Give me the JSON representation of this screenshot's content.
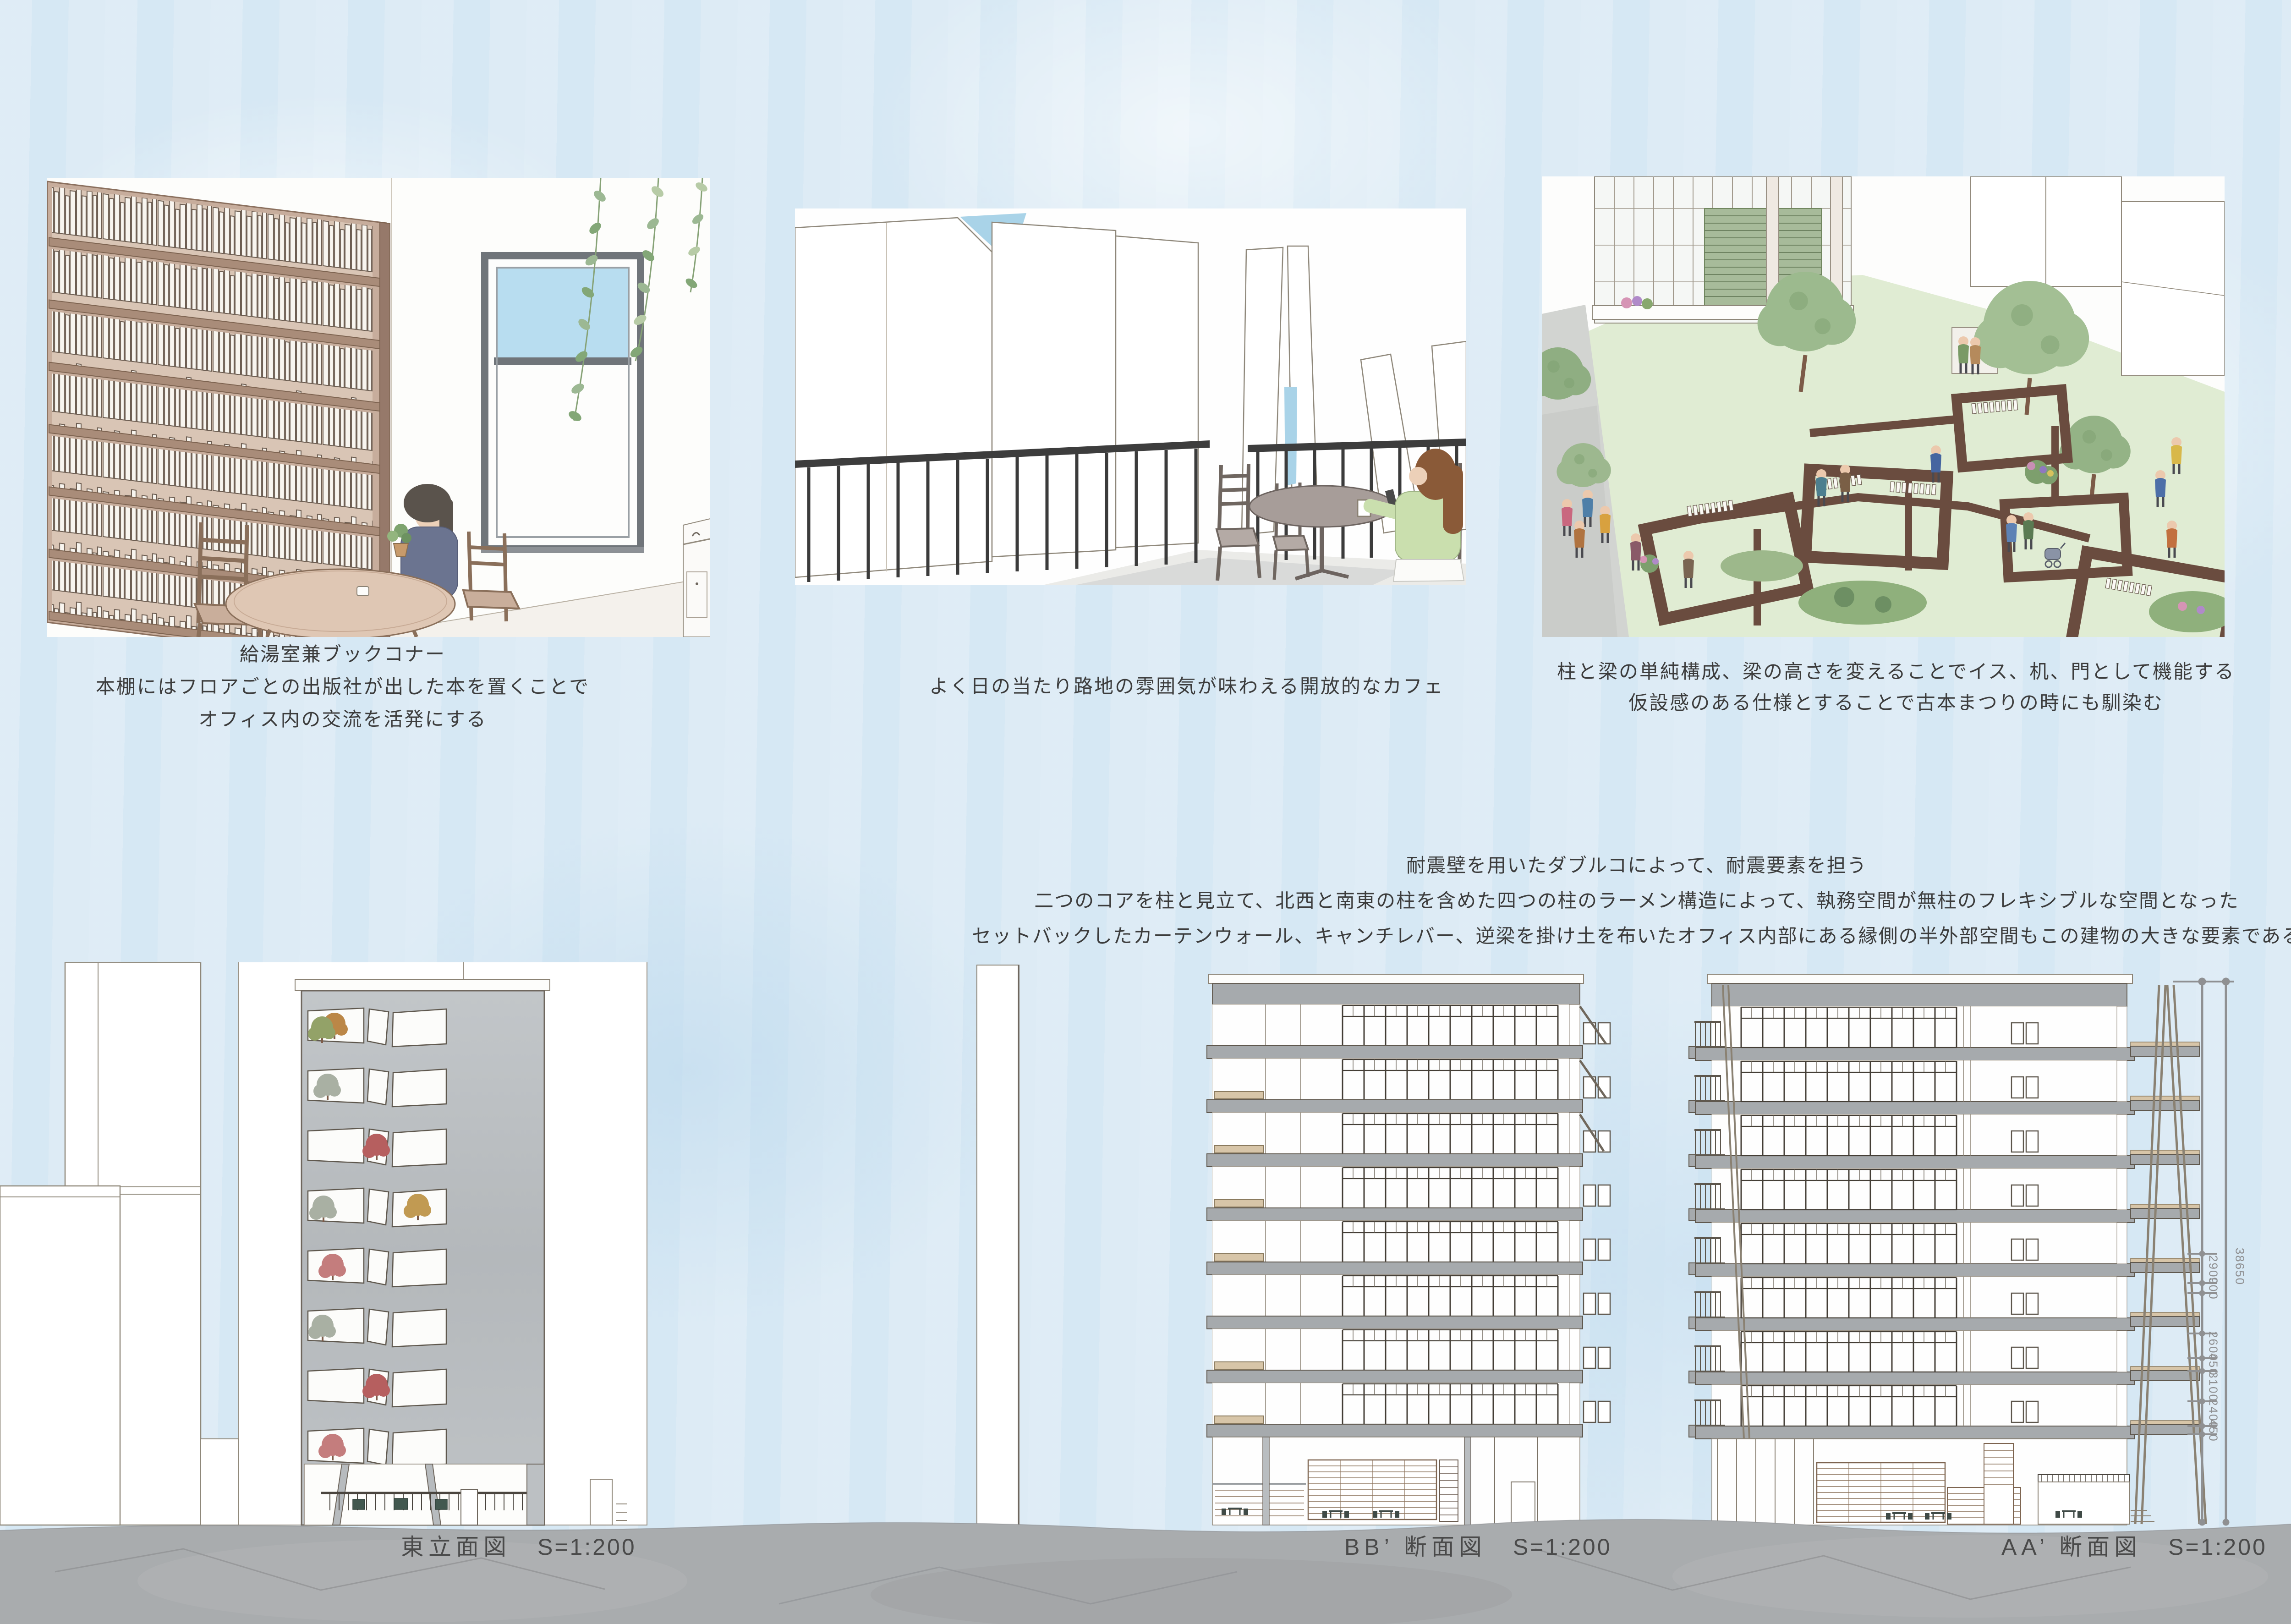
{
  "board": {
    "sky_color": "#d9e9f4",
    "ground_color": "#a9acae",
    "slab_gray": "#a6aaad",
    "timber_brown": "#6a4c3f",
    "bookshelf_wood": "#c7ad9c",
    "grass_green": "#e0ecd3",
    "sky_slit_blue": "#a9d3e8"
  },
  "renders": [
    {
      "name": "book-corner",
      "caption_lines": [
        "給湯室兼ブックコナー",
        "本棚にはフロアごとの出版社が出した本を置くことで",
        "オフィス内の交流を活発にする"
      ]
    },
    {
      "name": "alley-cafe",
      "caption_lines": [
        "よく日の当たり路地の雰囲気が味わえる開放的なカフェ"
      ]
    },
    {
      "name": "garden-frames",
      "caption_lines": [
        "柱と梁の単純構成、梁の高さを変えることでイス、机、門として機能する",
        "仮設感のある仕様とすることで古本まつりの時にも馴染む"
      ]
    }
  ],
  "structure_notes": {
    "lines": [
      "耐震壁を用いたダブルコによって、耐震要素を担う",
      "二つのコアを柱と見立て、北西と南東の柱を含めた四つの柱のラーメン構造によって、執務空間が無柱のフレキシブルな空間となった",
      "セットバックしたカーテンウォール、キャンチレバー、逆梁を掛け土を布いたオフィス内部にある縁側の半外部空間もこの建物の大きな要素である"
    ]
  },
  "drawings": [
    {
      "title": "東立面図",
      "scale": "S=1:200"
    },
    {
      "title": "BB’ 断面図",
      "scale": "S=1:200"
    },
    {
      "title": "AA’ 断面図",
      "scale": "S=1:200"
    }
  ],
  "dimensions": {
    "total": "38650",
    "segments": [
      "2900",
      "900",
      "2600",
      "450",
      "3100",
      "2400",
      "450"
    ]
  }
}
